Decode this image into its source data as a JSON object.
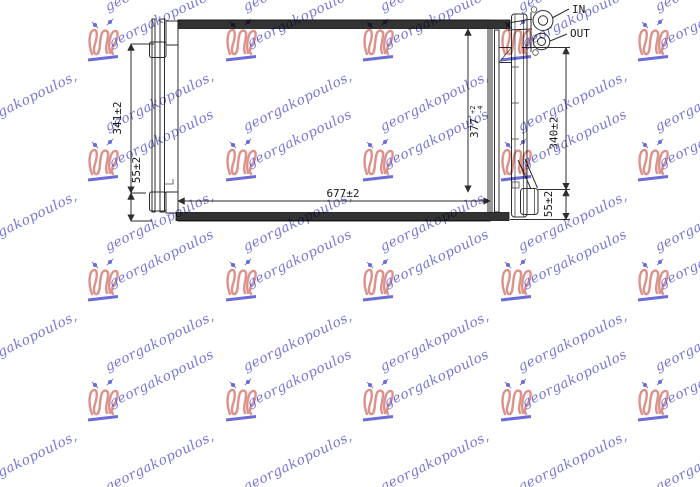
{
  "page": {
    "bg": "#ffffff",
    "width": 700,
    "height": 487
  },
  "watermark": {
    "text": "georgakopoulos,",
    "logo_text": "georgakopoulos",
    "text_color": "#5f5fd0",
    "logo_stroke_color": "#d9857e",
    "logo_accent_color": "#5b5bd6",
    "angle_deg": -26,
    "grid": {
      "col_step": 137.5,
      "row_step": 120,
      "emblem_x0": 85,
      "emblem_y0": 18,
      "text_x0": -27.5,
      "text_y0": 83,
      "cols": 6,
      "rows_from": -1,
      "rows_to": 3
    }
  },
  "drawing": {
    "line_color": "#2e2e2e",
    "header_bar_color": "#333333",
    "labels": {
      "dim_core_height": "341±2",
      "dim_left_offset": "55±2",
      "dim_core_width": "677±2",
      "dim_drier_height_value": "377",
      "dim_drier_height_tol_plus": "+2",
      "dim_drier_height_tol_minus": "-4",
      "dim_right_height": "340±2",
      "dim_right_offset": "55±2",
      "port_in": "IN",
      "port_out": "OUT"
    }
  }
}
